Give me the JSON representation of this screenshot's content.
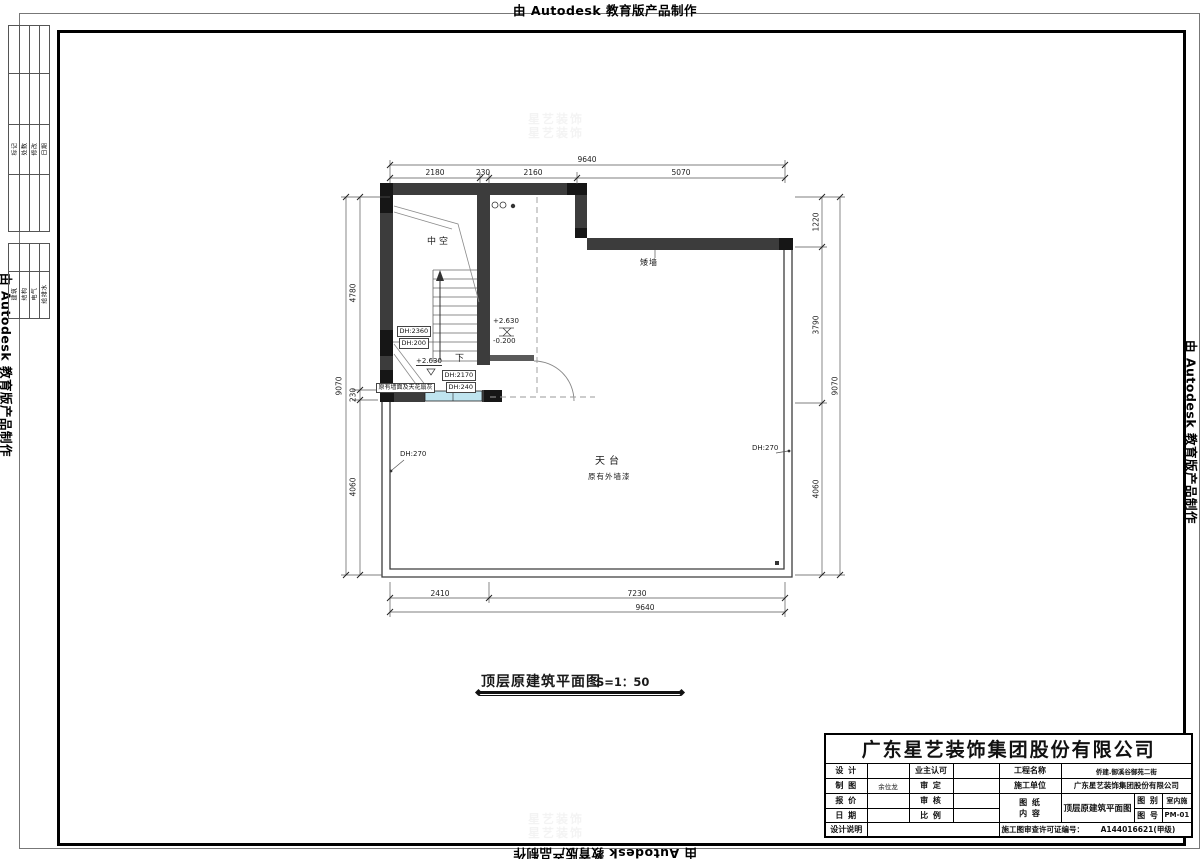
{
  "banners": {
    "text": "由 Autodesk 教育版产品制作"
  },
  "side_panel": {
    "revision_headers": [
      "标记",
      "处数",
      "修改",
      "日期"
    ],
    "discipline_headers": [
      "建筑",
      "结构",
      "电气",
      "给排水"
    ]
  },
  "watermark": {
    "text": "星艺装饰"
  },
  "plan": {
    "rooms": {
      "void": "中空",
      "down": "下",
      "low_wall": "矮墙",
      "terrace": "天台",
      "terrace_note": "原有外墙漆",
      "wall_note": "原有墙面及天花扇灰"
    },
    "levels": {
      "upper": "+2.630",
      "lower": "-0.200",
      "stair": "+2.630"
    },
    "door_heights": {
      "dh_2360": "DH:2360",
      "dh_200": "DH:200",
      "dh_2170": "DH:2170",
      "dh_240": "DH:240",
      "dh_270_left": "DH:270",
      "dh_270_right": "DH:270"
    },
    "dims": {
      "top_total": "9640",
      "top_segments": [
        "2180",
        "230",
        "2160",
        "5070"
      ],
      "bottom_segments": [
        "2410",
        "7230"
      ],
      "bottom_total": "9640",
      "left_segments": [
        "4780",
        "230",
        "4060"
      ],
      "left_total": "9070",
      "right_segments": [
        "1220",
        "3790",
        "4060"
      ],
      "right_total": "9070"
    }
  },
  "drawing_title": {
    "name": "顶层原建筑平面图",
    "scale": "S=1：50"
  },
  "title_block": {
    "company": "广东星艺装饰集团股份有限公司",
    "labels": {
      "design": "设 计",
      "draft": "制 图",
      "quote": "报 价",
      "date": "日 期",
      "design_notes": "设计说明",
      "owner_approval": "业主认可",
      "approve": "审 定",
      "check": "审 核",
      "scale": "比 例",
      "project_name": "工程名称",
      "constructor": "施工单位",
      "sheet": "图 纸",
      "content": "内 容",
      "category": "图 别",
      "number": "图 号",
      "permit": "施工图审查许可证编号："
    },
    "values": {
      "draft": "余位龙",
      "project_name": "侨建.御溪谷御苑二街",
      "constructor": "广东星艺装饰集团股份有限公司",
      "sheet_content": "顶层原建筑平面图",
      "category": "室内施",
      "number": "PM-01",
      "permit_no": "A144016621(甲级)"
    }
  }
}
